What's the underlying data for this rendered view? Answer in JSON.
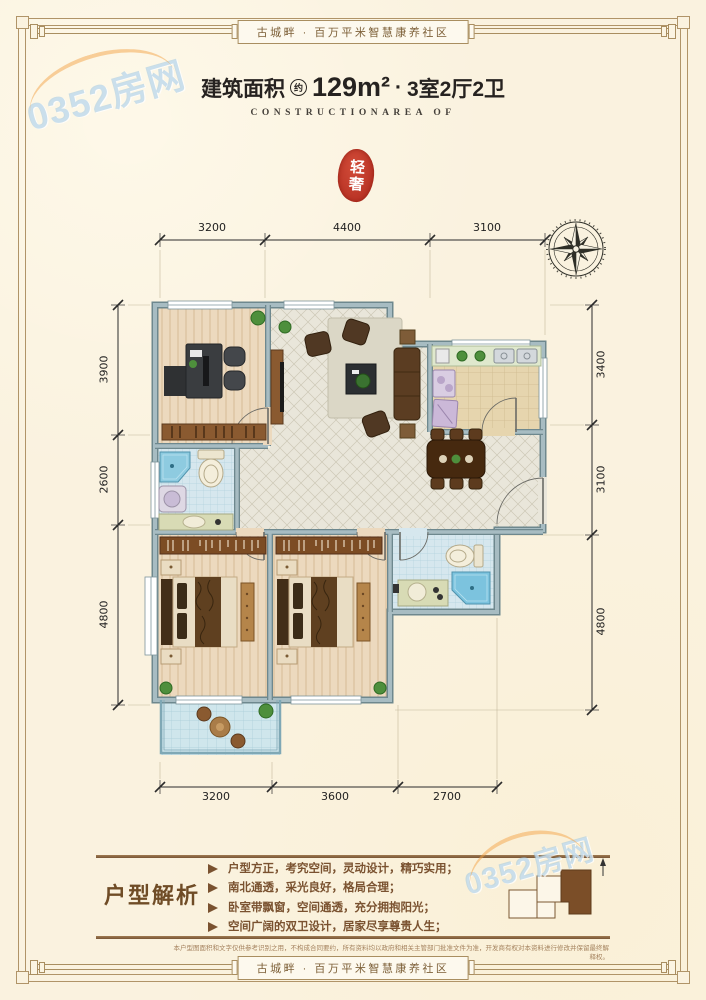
{
  "page": {
    "banner_top": "古城畔 · 百万平米智慧康养社区",
    "banner_bottom": "古城畔 · 百万平米智慧康养社区"
  },
  "title": {
    "prefix": "建筑面积",
    "approx_badge": "约",
    "area": "129m²",
    "separator": "·",
    "layout": "3室2厅2卫",
    "subtitle": "CONSTRUCTIONAREA OF"
  },
  "seal": {
    "text": "轻奢"
  },
  "dimensions": {
    "top": [
      "3200",
      "4400",
      "3100"
    ],
    "bottom": [
      "3200",
      "3600",
      "2700"
    ],
    "left": [
      "3900",
      "2600",
      "4800"
    ],
    "right": [
      "3400",
      "3100",
      "4800"
    ]
  },
  "analysis": {
    "heading": "户型解析",
    "bullets": [
      "户型方正，考究空间，灵动设计，精巧实用；",
      "南北通透，采光良好，格局合理；",
      "卧室带飘窗，空间通透，充分拥抱阳光；",
      "空间广阔的双卫设计，居家尽享尊贵人生；"
    ]
  },
  "disclaimer": "本户型图面积和文字仅供参考识别之用，不构成合同要约，所有资料均以政府和相关主管部门批准文件为准，开发商有权对本资料进行修改并保留最终解释权。",
  "watermark": {
    "text": "0352房网"
  },
  "colors": {
    "accent_red": "#c0392b",
    "frame_brown": "#a98e60",
    "text_brown": "#7a5230",
    "wall_gray_blue": "#a7bcc2"
  }
}
